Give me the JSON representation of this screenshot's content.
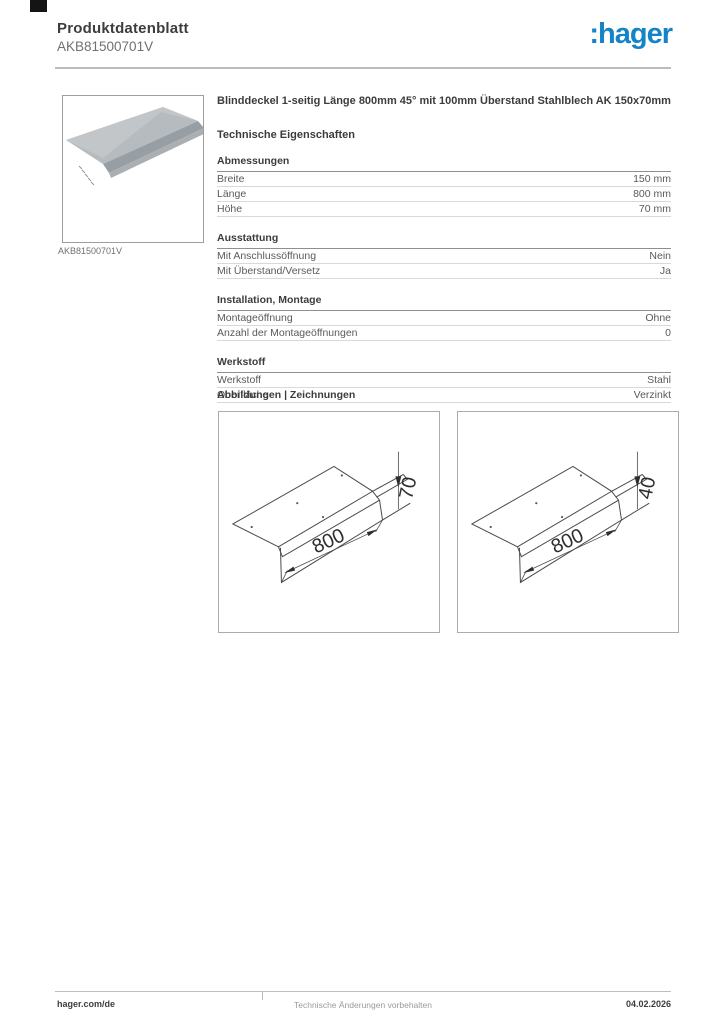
{
  "header": {
    "title": "Produktdatenblatt",
    "product_code": "AKB81500701V",
    "logo_text": ":hager",
    "logo_color": "#1583c8"
  },
  "product": {
    "image_caption": "AKB81500701V",
    "description": "Blinddeckel 1-seitig Länge 800mm 45° mit 100mm Überstand Stahlblech AK 150x70mm"
  },
  "tech_title": "Technische Eigenschaften",
  "spec_sections": [
    {
      "title": "Abmessungen",
      "rows": [
        {
          "label": "Breite",
          "value": "150 mm"
        },
        {
          "label": "Länge",
          "value": "800 mm"
        },
        {
          "label": "Höhe",
          "value": "70 mm"
        }
      ]
    },
    {
      "title": "Ausstattung",
      "rows": [
        {
          "label": "Mit Anschlussöffnung",
          "value": "Nein"
        },
        {
          "label": "Mit Überstand/Versetz",
          "value": "Ja"
        }
      ]
    },
    {
      "title": "Installation, Montage",
      "rows": [
        {
          "label": "Montageöffnung",
          "value": "Ohne"
        },
        {
          "label": "Anzahl der Montageöffnungen",
          "value": "0"
        }
      ]
    },
    {
      "title": "Werkstoff",
      "rows": [
        {
          "label": "Werkstoff",
          "value": "Stahl"
        },
        {
          "label": "Oberfläche",
          "value": "Verzinkt"
        }
      ]
    }
  ],
  "drawings_title": "Abbildungen | Zeichnungen",
  "drawings": [
    {
      "length_label": "800",
      "height_label": "70"
    },
    {
      "length_label": "800",
      "height_label": "40"
    }
  ],
  "footer": {
    "website": "hager.com/de",
    "disclaimer": "Technische Änderungen vorbehalten",
    "date": "04.02.2026"
  }
}
